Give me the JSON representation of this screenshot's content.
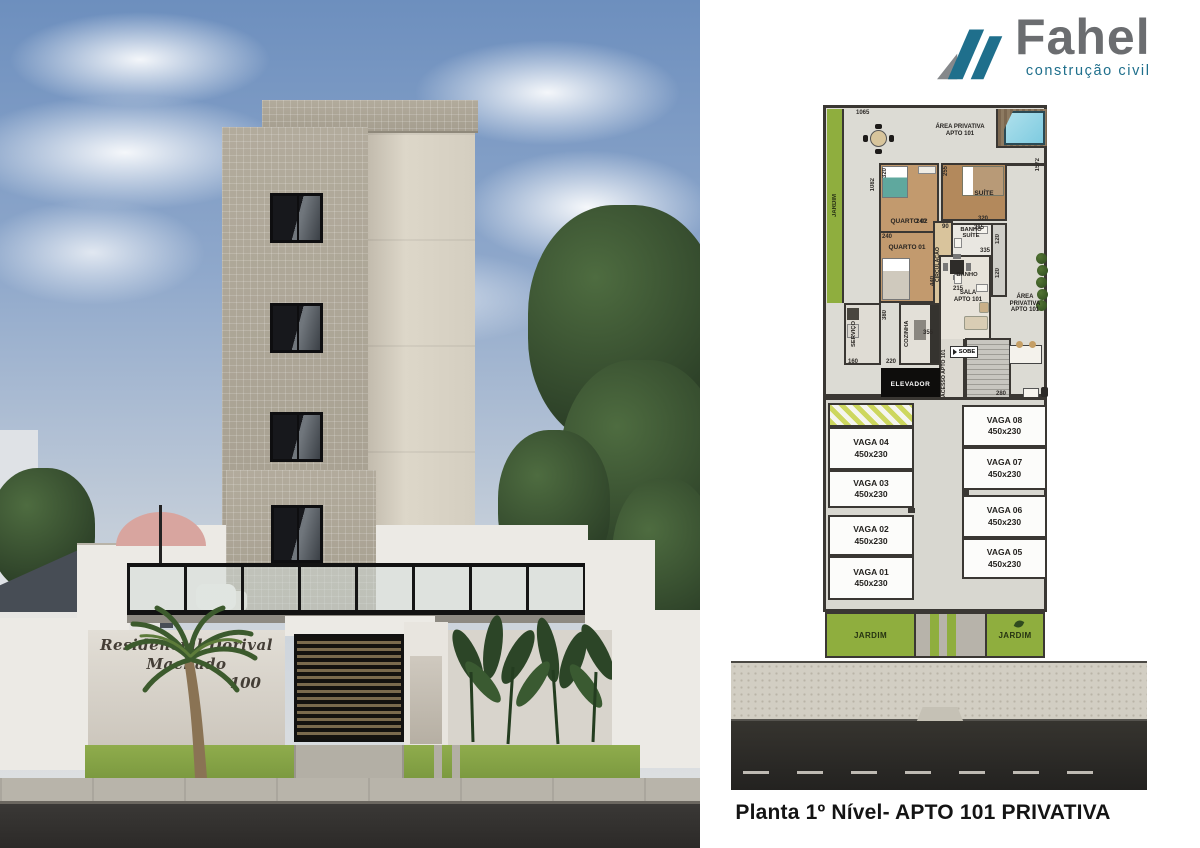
{
  "logo": {
    "brand": "Fahel",
    "tagline": "construção civil",
    "brand_color": "#6b6d70",
    "accent_color": "#1f6f8c"
  },
  "photo": {
    "sign_line1": "Residencial Dorival Machado",
    "sign_line2": "100"
  },
  "plan": {
    "colors": {
      "garden_green": "#8fae3e",
      "wall": "#3a3733",
      "wood": "#c29a6e",
      "pool_blue": "#7ecbe0"
    },
    "jardim_left": "JARDIM",
    "area_privativa_top": "ÁREA PRIVATIVA APTO 101",
    "area_privativa_right": "ÁREA PRIVATIVA APTO 101",
    "rooms": {
      "quarto02": "QUARTO 02",
      "quarto01": "QUARTO 01",
      "suite": "SUÍTE",
      "banho_suite": "BANHO SUÍTE",
      "banho": "BANHO",
      "circulacao": "CIRCULAÇÃO",
      "sala": "SALA APTO 101",
      "cozinha": "COZINHA",
      "servico": "SERVIÇO",
      "acesso": "ACESSO APTO 101",
      "sobe": "SOBE",
      "elevador": "ELEVADOR"
    },
    "dims": {
      "lot_top": "1065",
      "lot_right": "1572",
      "left_side": "1082",
      "quarto02_left": "320",
      "quarto02_right": "240",
      "quarto01_left": "240",
      "suite_left": "255",
      "suite_bottom": "320",
      "circ_top": "90",
      "banho_suite_top": "215",
      "banho_suite_right": "120",
      "banho_bottom": "215",
      "banho_right": "120",
      "sala_top": "335",
      "sala_left": "440",
      "cozinha_top": "355",
      "servico_right": "380",
      "servico_bottom": "160",
      "cozinha_bottom": "220",
      "hall_bottom": "280"
    },
    "vagas_left": [
      {
        "name": "VAGA 04",
        "size": "450x230"
      },
      {
        "name": "VAGA 03",
        "size": "450x230"
      },
      {
        "name": "VAGA 02",
        "size": "450x230"
      },
      {
        "name": "VAGA 01",
        "size": "450x230"
      }
    ],
    "vagas_right": [
      {
        "name": "VAGA 08",
        "size": "450x230"
      },
      {
        "name": "VAGA 07",
        "size": "450x230"
      },
      {
        "name": "VAGA 06",
        "size": "450x230"
      },
      {
        "name": "VAGA 05",
        "size": "450x230"
      }
    ],
    "jardim_bottom_left": "JARDIM",
    "jardim_bottom_right": "JARDIM"
  },
  "caption": "Planta 1º Nível- APTO 101 PRIVATIVA"
}
